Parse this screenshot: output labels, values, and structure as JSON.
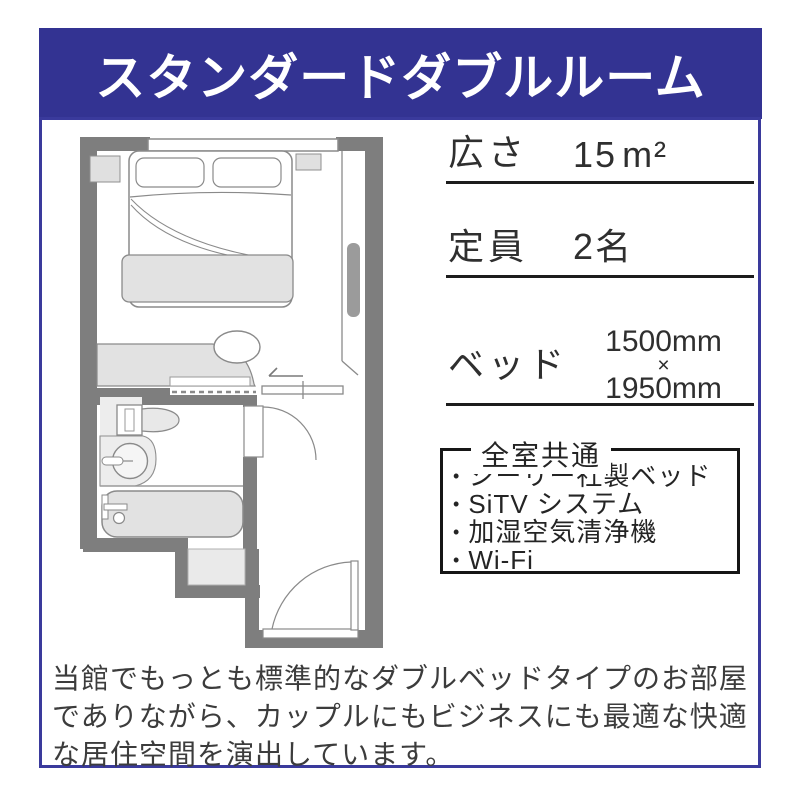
{
  "title": "スタンダードダブルルーム",
  "specs": {
    "area_label": "広さ",
    "area_value": "15",
    "area_unit": "m²",
    "capacity_label": "定員",
    "capacity_value": "2名",
    "bed_label": "ベッド",
    "bed_width": "1500mm",
    "bed_times": "×",
    "bed_length": "1950mm"
  },
  "common_features": {
    "title": "全室共通",
    "bullet": "•",
    "items": [
      "シーリー社製ベッド",
      "SiTV システム",
      "加湿空気清浄機",
      "Wi-Fi"
    ]
  },
  "description_lines": [
    "当館でもっとも標準的なダブルベッドタイプのお部屋",
    "でありながら、カップルにもビジネスにも最適な快適",
    "な居住空間を演出しています。"
  ],
  "colors": {
    "banner_bg": "#333392",
    "banner_text": "#ffffff",
    "card_border": "#3a3a9c",
    "feature_box_border": "#161616",
    "underline": "#1c1c1c",
    "wall_gray": "#7e7e7e",
    "fixture_light_gray": "#e2e2e2",
    "body_text": "#3c3c3c"
  }
}
